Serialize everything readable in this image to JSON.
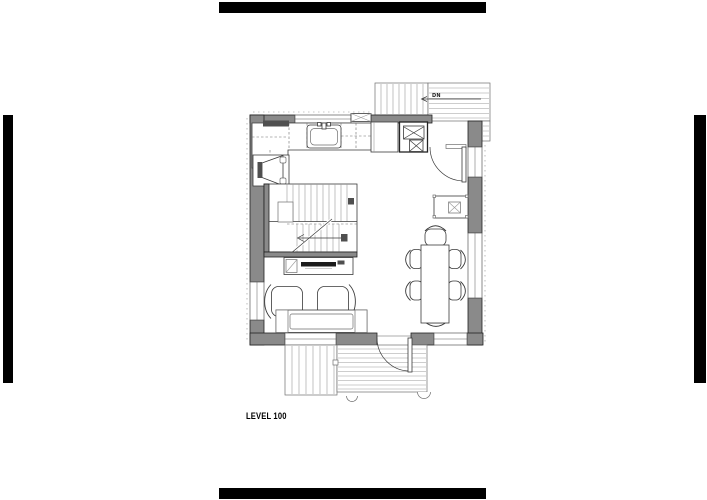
{
  "drawing": {
    "level_label": "LEVEL 100",
    "stair_note": "DN"
  },
  "colors": {
    "background": "#ffffff",
    "crop_mark": "#000000",
    "wall_fill": "#8a8a8a",
    "wall_outline": "#222222",
    "line_dark": "#3a3a3a",
    "line_light": "#9b9b9b",
    "tv_fill": "#1b1b1b",
    "text": "#000000"
  }
}
